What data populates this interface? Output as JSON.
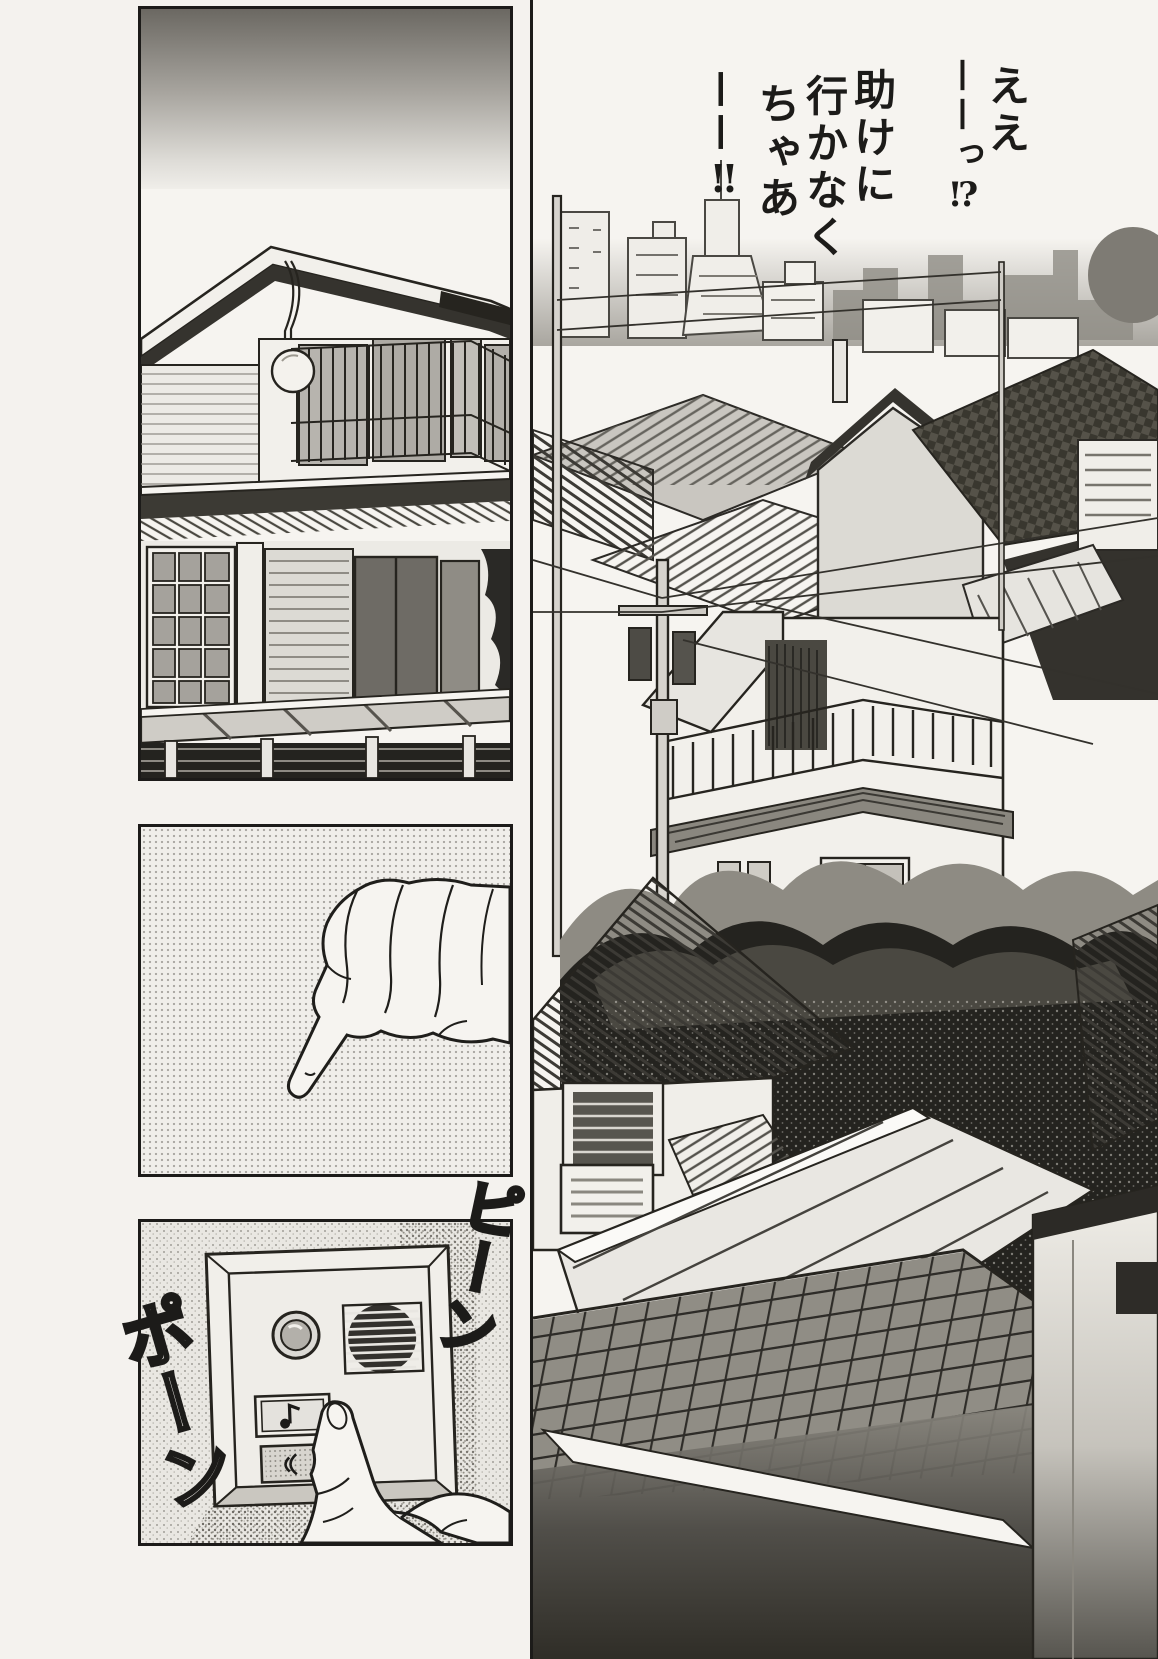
{
  "page": {
    "background": "#f4f2ee",
    "ink": "#1c1b19",
    "label": "black-and-white manga page, four panels"
  },
  "dialogue": {
    "full_text": "ええ——っ!? 助けに行かなくちゃあ——!!",
    "columns": [
      "ええ",
      "——っ⁉",
      "助けに",
      "行かなく",
      "ちゃあ",
      "——‼"
    ]
  },
  "sfx": {
    "doorbell_chime_right": "ピーン",
    "doorbell_chime_left": "ポーン",
    "combined_reading": "ピンポーン"
  },
  "panels": {
    "house_exterior": {
      "label": "two-story house exterior with balcony, windows, porch awning and hedge fence under a dark gradient sky"
    },
    "pointing_hand": {
      "label": "hand with index finger extended reaching to press a button, halftone background"
    },
    "doorbell": {
      "label": "close-up of intercom doorbell unit: camera lens, speaker grille, chime button with music-note icon being pressed by a finger, talk button with speaker icon",
      "call_button_icon": "music-note",
      "talk_button_icon": "speaker"
    },
    "cityscape": {
      "label": "view over dense residential rooftops, power poles and wires, dark foliage, foreground tiled roof, distant city skyline"
    }
  },
  "colors": {
    "tone_light": "#d8d6d1",
    "tone_mid": "#b3b0aa",
    "tone_dark": "#55534e",
    "foliage_dark": "#24231f"
  }
}
